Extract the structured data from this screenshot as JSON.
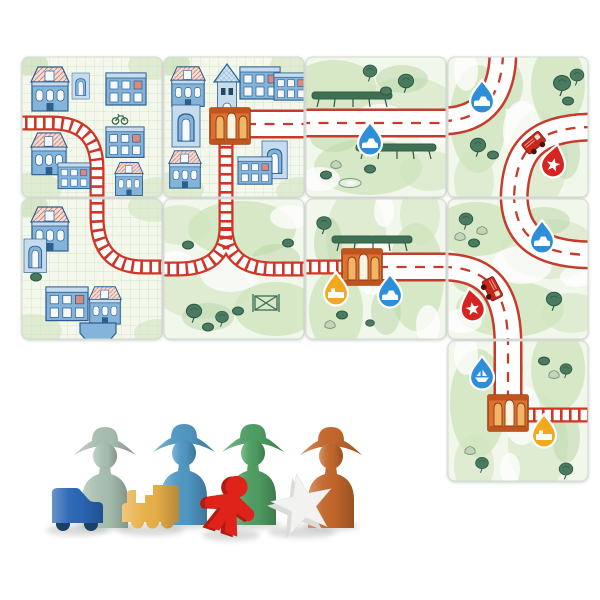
{
  "scene": {
    "description": "Train board game: nine illustrated square tiles (blue city tiles with red railways, green meadow tiles with red-edged roads, orange stations, drop-shaped pick-up markers, fire trucks, trees and hedges) laid in a grid, with wooden playing pieces below: four person pawns, a blue car, a yellow locomotive, a red meeple and a white star.",
    "background": "#ffffff"
  },
  "palette": {
    "road_red": "#c63b2b",
    "track_red": "#d03526",
    "grass": "#cfe3bd",
    "grass_deep": "#b7d6a4",
    "tree": "#4a7a5f",
    "hedge": "#3f7053",
    "city_bg": "#f3f7ec",
    "grid_line": "#cddec1",
    "bldg": "#85b4da",
    "bldg_light": "#c6dcee",
    "bldg_dark": "#2c5f8e",
    "window": "#f5f9fc",
    "station_body": "#dc7231",
    "station_dark": "#9c4413",
    "station_light": "#f2b566",
    "marker_blue": "#2e8ed8",
    "marker_red": "#d62420",
    "marker_yellow": "#f3a91e",
    "truck_red": "#c8281c",
    "tile_border": "#d5dad2"
  },
  "board": {
    "rows": 3,
    "cols": 4,
    "tile_count": 9,
    "tiles": [
      {
        "id": "city-rail-curve",
        "row": 1,
        "col": 1,
        "terrain": "city",
        "features": [
          "railway curving from west edge to south edge",
          "blue houses with pink hatched roofs",
          "bicycle doodle"
        ],
        "markers": []
      },
      {
        "id": "city-station",
        "row": 1,
        "col": 2,
        "terrain": "city",
        "features": [
          "orange station in centre with clock tower",
          "road running east from station",
          "railway running south from station"
        ],
        "markers": []
      },
      {
        "id": "meadow-straight-road",
        "row": 1,
        "col": 3,
        "terrain": "meadow",
        "features": [
          "straight road west to east",
          "two long hedges",
          "trees, rocks and pond"
        ],
        "markers": [
          {
            "color": "blue",
            "icon": "car"
          }
        ]
      },
      {
        "id": "meadow-two-road-curves",
        "row": 1,
        "col": 4,
        "terrain": "meadow",
        "features": [
          "road curve west to north",
          "road curve east to south",
          "fire truck on lower road",
          "trees"
        ],
        "markers": [
          {
            "color": "blue",
            "icon": "car"
          },
          {
            "color": "red",
            "icon": "star"
          }
        ]
      },
      {
        "id": "city-rail-curve-2",
        "row": 2,
        "col": 1,
        "terrain": "city",
        "features": [
          "railway curving from north edge to east edge",
          "blue houses",
          "boat dock"
        ],
        "markers": []
      },
      {
        "id": "meadow-rail-junction",
        "row": 2,
        "col": 2,
        "terrain": "meadow",
        "features": [
          "railway Y-junction: north line splits to west and east",
          "bushes",
          "field gate"
        ],
        "markers": []
      },
      {
        "id": "meadow-station",
        "row": 2,
        "col": 3,
        "terrain": "meadow",
        "features": [
          "railway from west ending at orange station",
          "road running east from station",
          "hedge behind station"
        ],
        "markers": [
          {
            "color": "yellow",
            "icon": "train"
          },
          {
            "color": "blue",
            "icon": "car"
          }
        ]
      },
      {
        "id": "meadow-two-road-curves-2",
        "row": 2,
        "col": 4,
        "terrain": "meadow",
        "features": [
          "road curve north to east",
          "road curve west to south",
          "fire truck on lower road",
          "trees and rocks"
        ],
        "markers": [
          {
            "color": "blue",
            "icon": "car"
          },
          {
            "color": "red",
            "icon": "star"
          }
        ]
      },
      {
        "id": "meadow-station-2",
        "row": 3,
        "col": 4,
        "terrain": "meadow",
        "features": [
          "road from north ending at orange station",
          "railway running east from station",
          "trees and rocks"
        ],
        "markers": [
          {
            "color": "blue",
            "icon": "boat"
          },
          {
            "color": "yellow",
            "icon": "train"
          }
        ]
      }
    ]
  },
  "pieces": {
    "pawns": [
      {
        "name": "pawn-sage",
        "label": "sage green person pawn",
        "color": "#a7bfb0"
      },
      {
        "name": "pawn-blue",
        "label": "blue person pawn",
        "color": "#4f97c2"
      },
      {
        "name": "pawn-green",
        "label": "green person pawn",
        "color": "#4f9e63"
      },
      {
        "name": "pawn-orange",
        "label": "orange person pawn",
        "color": "#c2672c"
      }
    ],
    "tokens": [
      {
        "name": "token-car",
        "label": "blue car",
        "color": "#2a66b5"
      },
      {
        "name": "token-train",
        "label": "yellow locomotive",
        "color": "#e8b04a"
      },
      {
        "name": "token-meeple",
        "label": "red meeple",
        "color": "#df231a"
      },
      {
        "name": "token-star",
        "label": "white star",
        "color": "#f2f2f0"
      }
    ]
  }
}
